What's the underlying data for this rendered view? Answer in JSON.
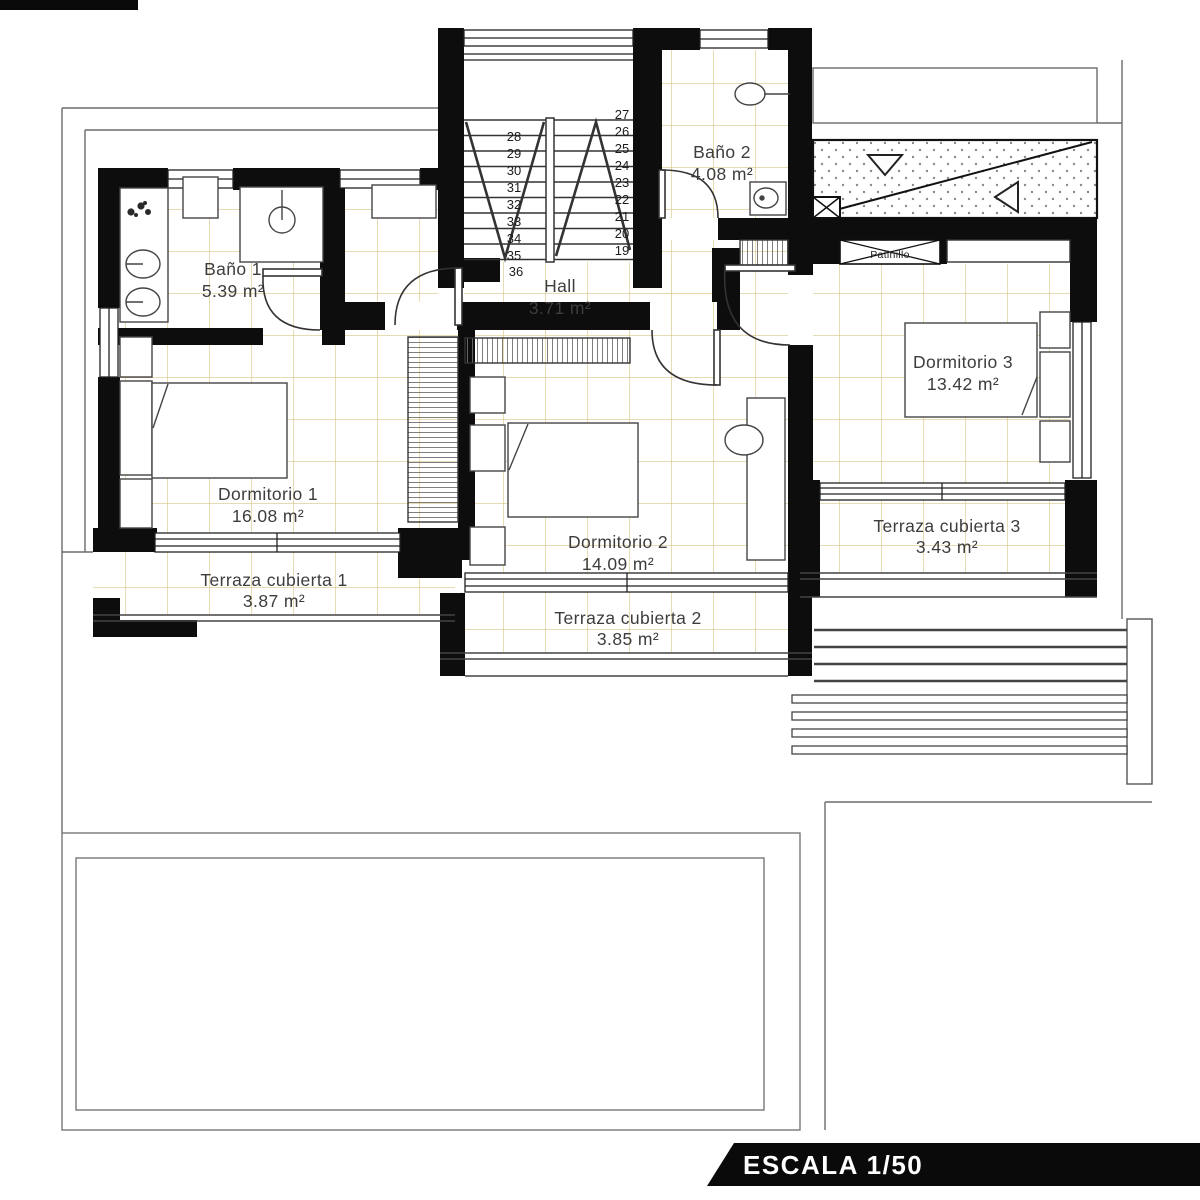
{
  "banner": {
    "text": "ESCALA 1/50"
  },
  "rooms": {
    "bano1": {
      "name": "Baño 1",
      "area": "5.39 m²"
    },
    "bano2": {
      "name": "Baño 2",
      "area": "4.08 m²"
    },
    "hall": {
      "name": "Hall",
      "area": "3.71 m²"
    },
    "dorm1": {
      "name": "Dormitorio 1",
      "area": "16.08 m²"
    },
    "dorm2": {
      "name": "Dormitorio 2",
      "area": "14.09 m²"
    },
    "dorm3": {
      "name": "Dormitorio 3",
      "area": "13.42 m²"
    },
    "terraza1": {
      "name": "Terraza cubierta 1",
      "area": "3.87 m²"
    },
    "terraza2": {
      "name": "Terraza cubierta 2",
      "area": "3.85 m²"
    },
    "terraza3": {
      "name": "Terraza cubierta 3",
      "area": "3.43 m²"
    }
  },
  "patinillo": "Patinillo",
  "stairs": {
    "left": [
      "28",
      "29",
      "30",
      "31",
      "32",
      "33",
      "34",
      "35"
    ],
    "right": [
      "27",
      "26",
      "25",
      "24",
      "23",
      "22",
      "21",
      "20",
      "19"
    ],
    "last": "36"
  },
  "colors": {
    "wall": "#0d0d0d",
    "tile_line": "#d8c583",
    "thin_line": "#6b6b6b",
    "banner_bg": "#0a0a0a"
  }
}
